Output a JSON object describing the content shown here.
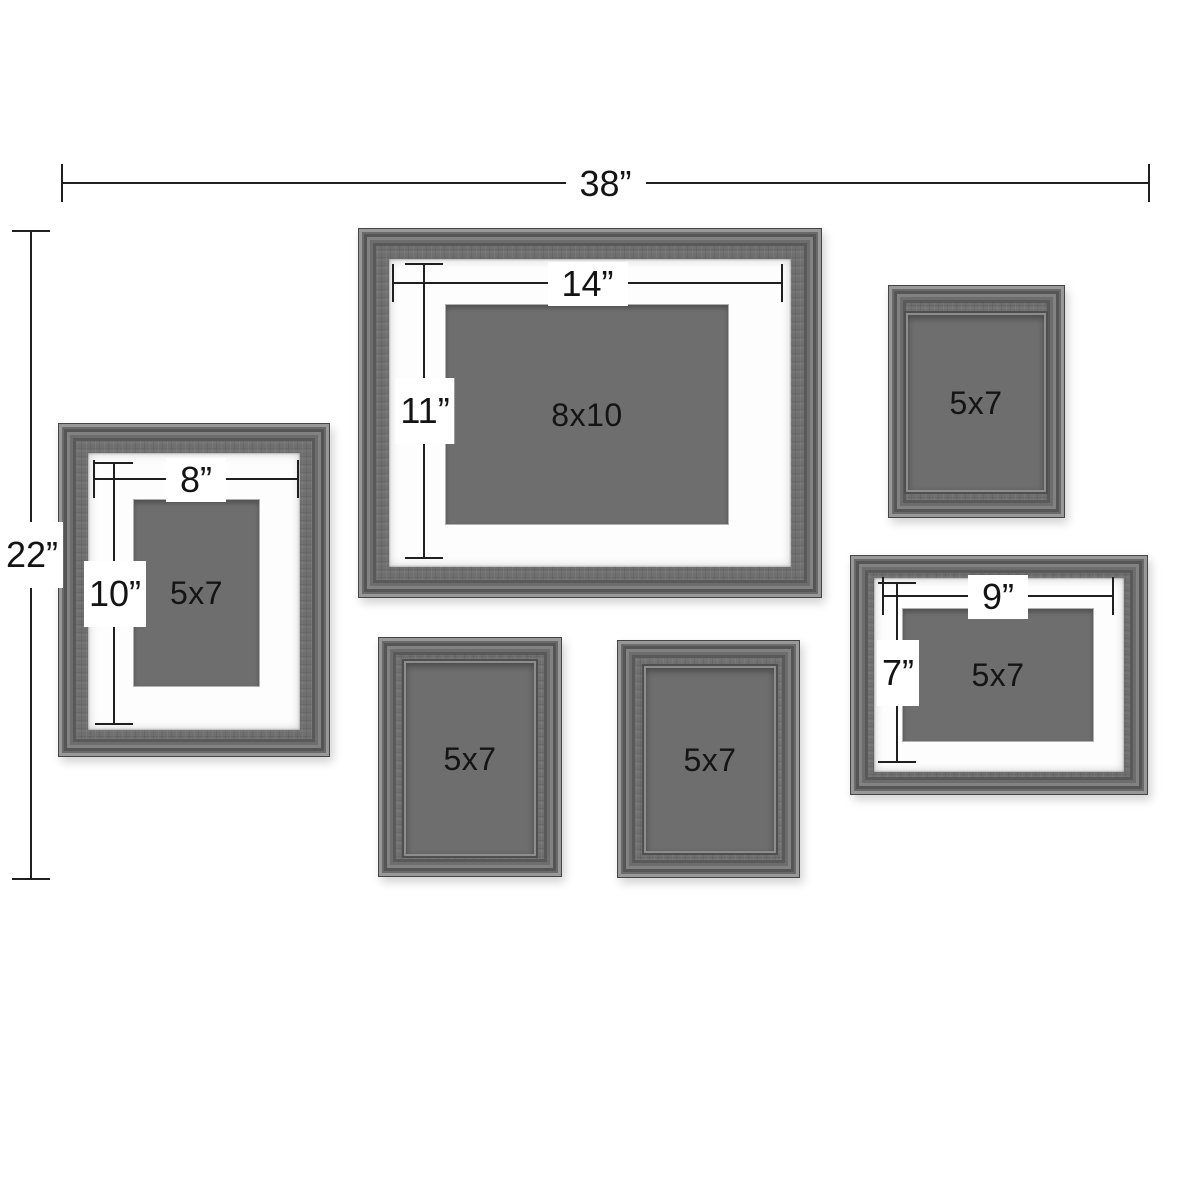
{
  "diagram": {
    "type": "gallery-wall-frame-set-dimension-diagram",
    "overall": {
      "width_label": "38”",
      "height_label": "22”"
    },
    "frames": [
      {
        "id": "frame-8x10-matted",
        "photo_label": "8x10",
        "mat_width_label": "14”",
        "mat_height_label": "11”"
      },
      {
        "id": "frame-5x7-matted-left",
        "photo_label": "5x7",
        "mat_width_label": "8”",
        "mat_height_label": "10”"
      },
      {
        "id": "frame-5x7-top-right",
        "photo_label": "5x7"
      },
      {
        "id": "frame-5x7-matted-right",
        "photo_label": "5x7",
        "mat_width_label": "9”",
        "mat_height_label": "7”"
      },
      {
        "id": "frame-5x7-bottom-left",
        "photo_label": "5x7"
      },
      {
        "id": "frame-5x7-bottom-right",
        "photo_label": "5x7"
      }
    ],
    "colors": {
      "background": "#ffffff",
      "frame_wood": "#6f6f6f",
      "mat": "#fdfdfd",
      "photo_area": "#6e6e6e",
      "dimension_line": "#1f1f1f"
    }
  }
}
